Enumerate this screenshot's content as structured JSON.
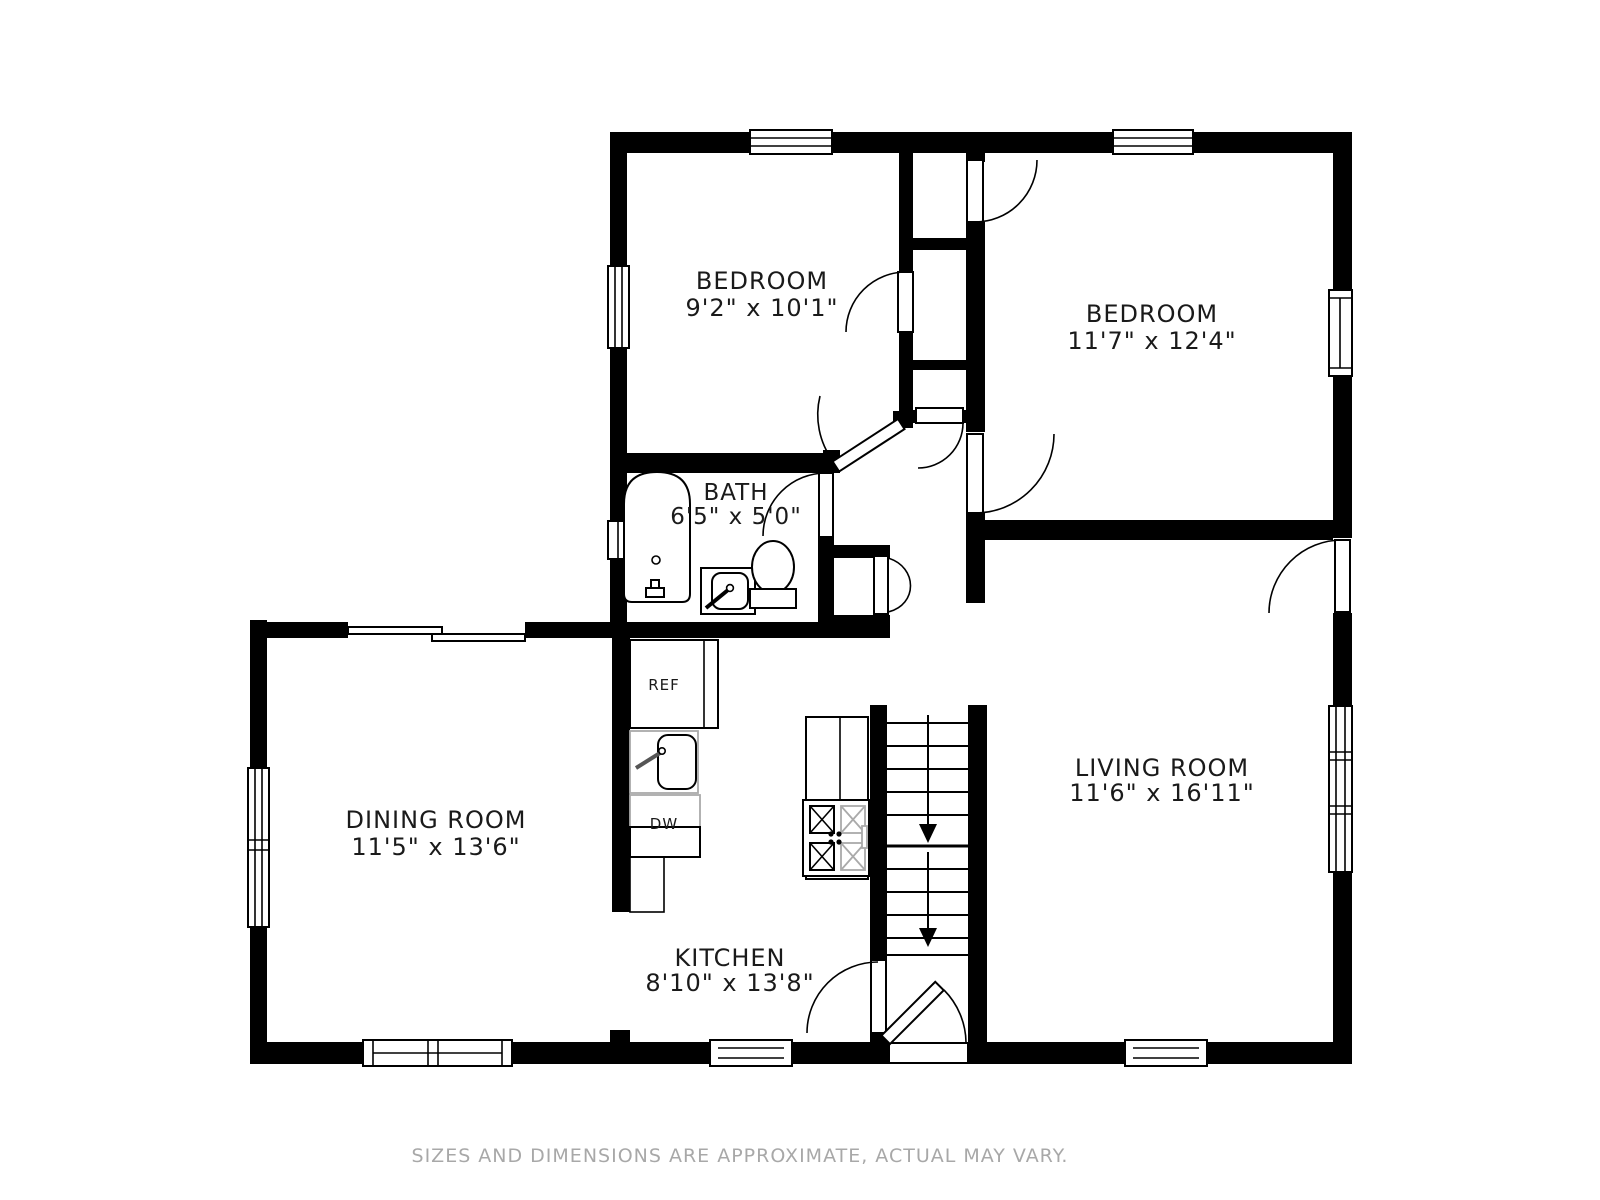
{
  "plan": {
    "rooms": [
      {
        "name": "BEDROOM",
        "dims": "9'2\" x 10'1\""
      },
      {
        "name": "BEDROOM",
        "dims": "11'7\" x 12'4\""
      },
      {
        "name": "BATH",
        "dims": "6'5\" x 5'0\""
      },
      {
        "name": "DINING ROOM",
        "dims": "11'5\" x 13'6\""
      },
      {
        "name": "KITCHEN",
        "dims": "8'10\" x 13'8\""
      },
      {
        "name": "LIVING ROOM",
        "dims": "11'6\" x 16'11\""
      }
    ],
    "appliances": {
      "refrigerator": "REF",
      "dishwasher": "DW"
    },
    "disclaimer": "SIZES AND DIMENSIONS ARE APPROXIMATE, ACTUAL MAY VARY.",
    "colors": {
      "wall": "#000000",
      "text": "#1a1a1a",
      "disclaimer_text": "#a8a8a8",
      "fixture_gray": "#aaaaaa"
    }
  }
}
